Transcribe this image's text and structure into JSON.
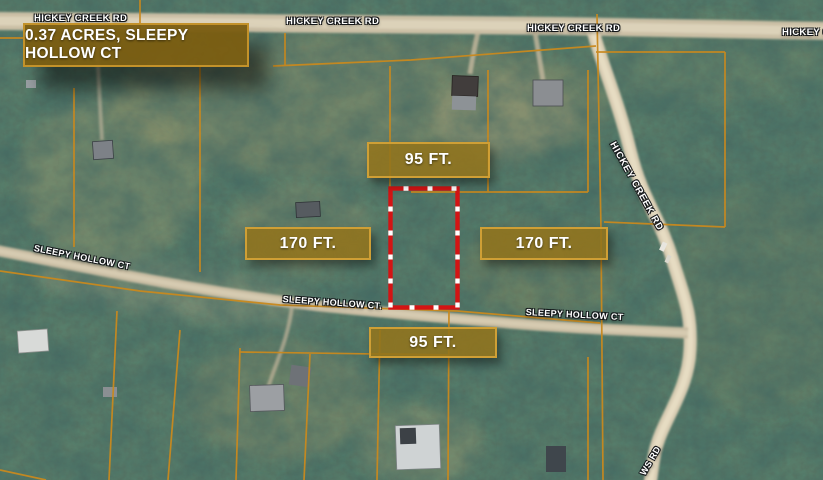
{
  "title_box": {
    "text": "0.37 ACRES, SLEEPY HOLLOW CT"
  },
  "measurements": {
    "top": "95 FT.",
    "bottom": "95 FT.",
    "left": "170 FT.",
    "right": "170 FT."
  },
  "road_labels": [
    {
      "id": "hickey-creek-rd-top-left",
      "text": "HICKEY CREEK RD"
    },
    {
      "id": "hickey-creek-rd-top-center",
      "text": "HICKEY CREEK RD"
    },
    {
      "id": "hickey-creek-rd-top-right",
      "text": "HICKEY CREEK RD"
    },
    {
      "id": "hickey-creek-rd-top-edge",
      "text": "HICKEY CREEK RD"
    },
    {
      "id": "hickey-creek-rd-side",
      "text": "HICKEY CREEK RD"
    },
    {
      "id": "sleepy-hollow-ct-left",
      "text": "SLEEPY HOLLOW CT"
    },
    {
      "id": "sleepy-hollow-ct-center",
      "text": "SLEEPY HOLLOW CT."
    },
    {
      "id": "sleepy-hollow-ct-right",
      "text": "SLEEPY HOLLOW CT"
    },
    {
      "id": "ws-rd-bottom",
      "text": "WS RD"
    }
  ],
  "colors": {
    "parcel_outline": "#d31414",
    "boundary_lines": "#c9891e",
    "label_box_bg": "#92741ce0",
    "label_box_border": "#cf9f35",
    "title_box_bg": "#7b5e12f5",
    "title_box_border": "#c3922a",
    "road_label_text": "#ffffff"
  }
}
